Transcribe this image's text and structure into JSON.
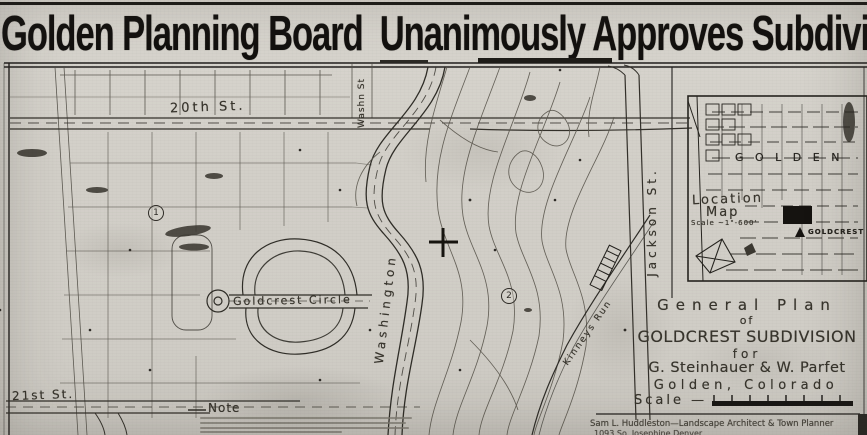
{
  "page": {
    "headline": "Golden Planning Board  Unanimously Approves Subdivision"
  },
  "map": {
    "street_labels": {
      "st20": "20th St.",
      "washn_top": "Washn St",
      "washington": "Washington",
      "goldcrest_circle": "Goldcrest Circle",
      "jackson": "Jackson St.",
      "st21": "21st St.",
      "kinneys_run": "Kinneys Run"
    },
    "markers": {
      "circle1": "1",
      "circle2": "2"
    },
    "note_heading": "Note",
    "location_map": {
      "city_label": "G O L D E N",
      "title_line1": "Location",
      "title_line2": "Map",
      "scale": "Scale ~1\"-600'",
      "site_label": "GOLDCREST"
    },
    "title_block": {
      "line1": "General Plan",
      "line2": "of",
      "line3": "GOLDCREST SUBDIVISION",
      "line4": "for",
      "line5": "G. Steinhauer & W. Parfet",
      "line6": "Golden, Colorado",
      "scale_label": "Scale —"
    },
    "credit": {
      "line1": "Sam L. Huddleston—Landscape Architect & Town Planner",
      "line2": "1093 So. Josephine   Denver"
    }
  },
  "colors": {
    "paper": "#d2cfc8",
    "ink": "#1c1a17",
    "line": "#3a372f"
  }
}
